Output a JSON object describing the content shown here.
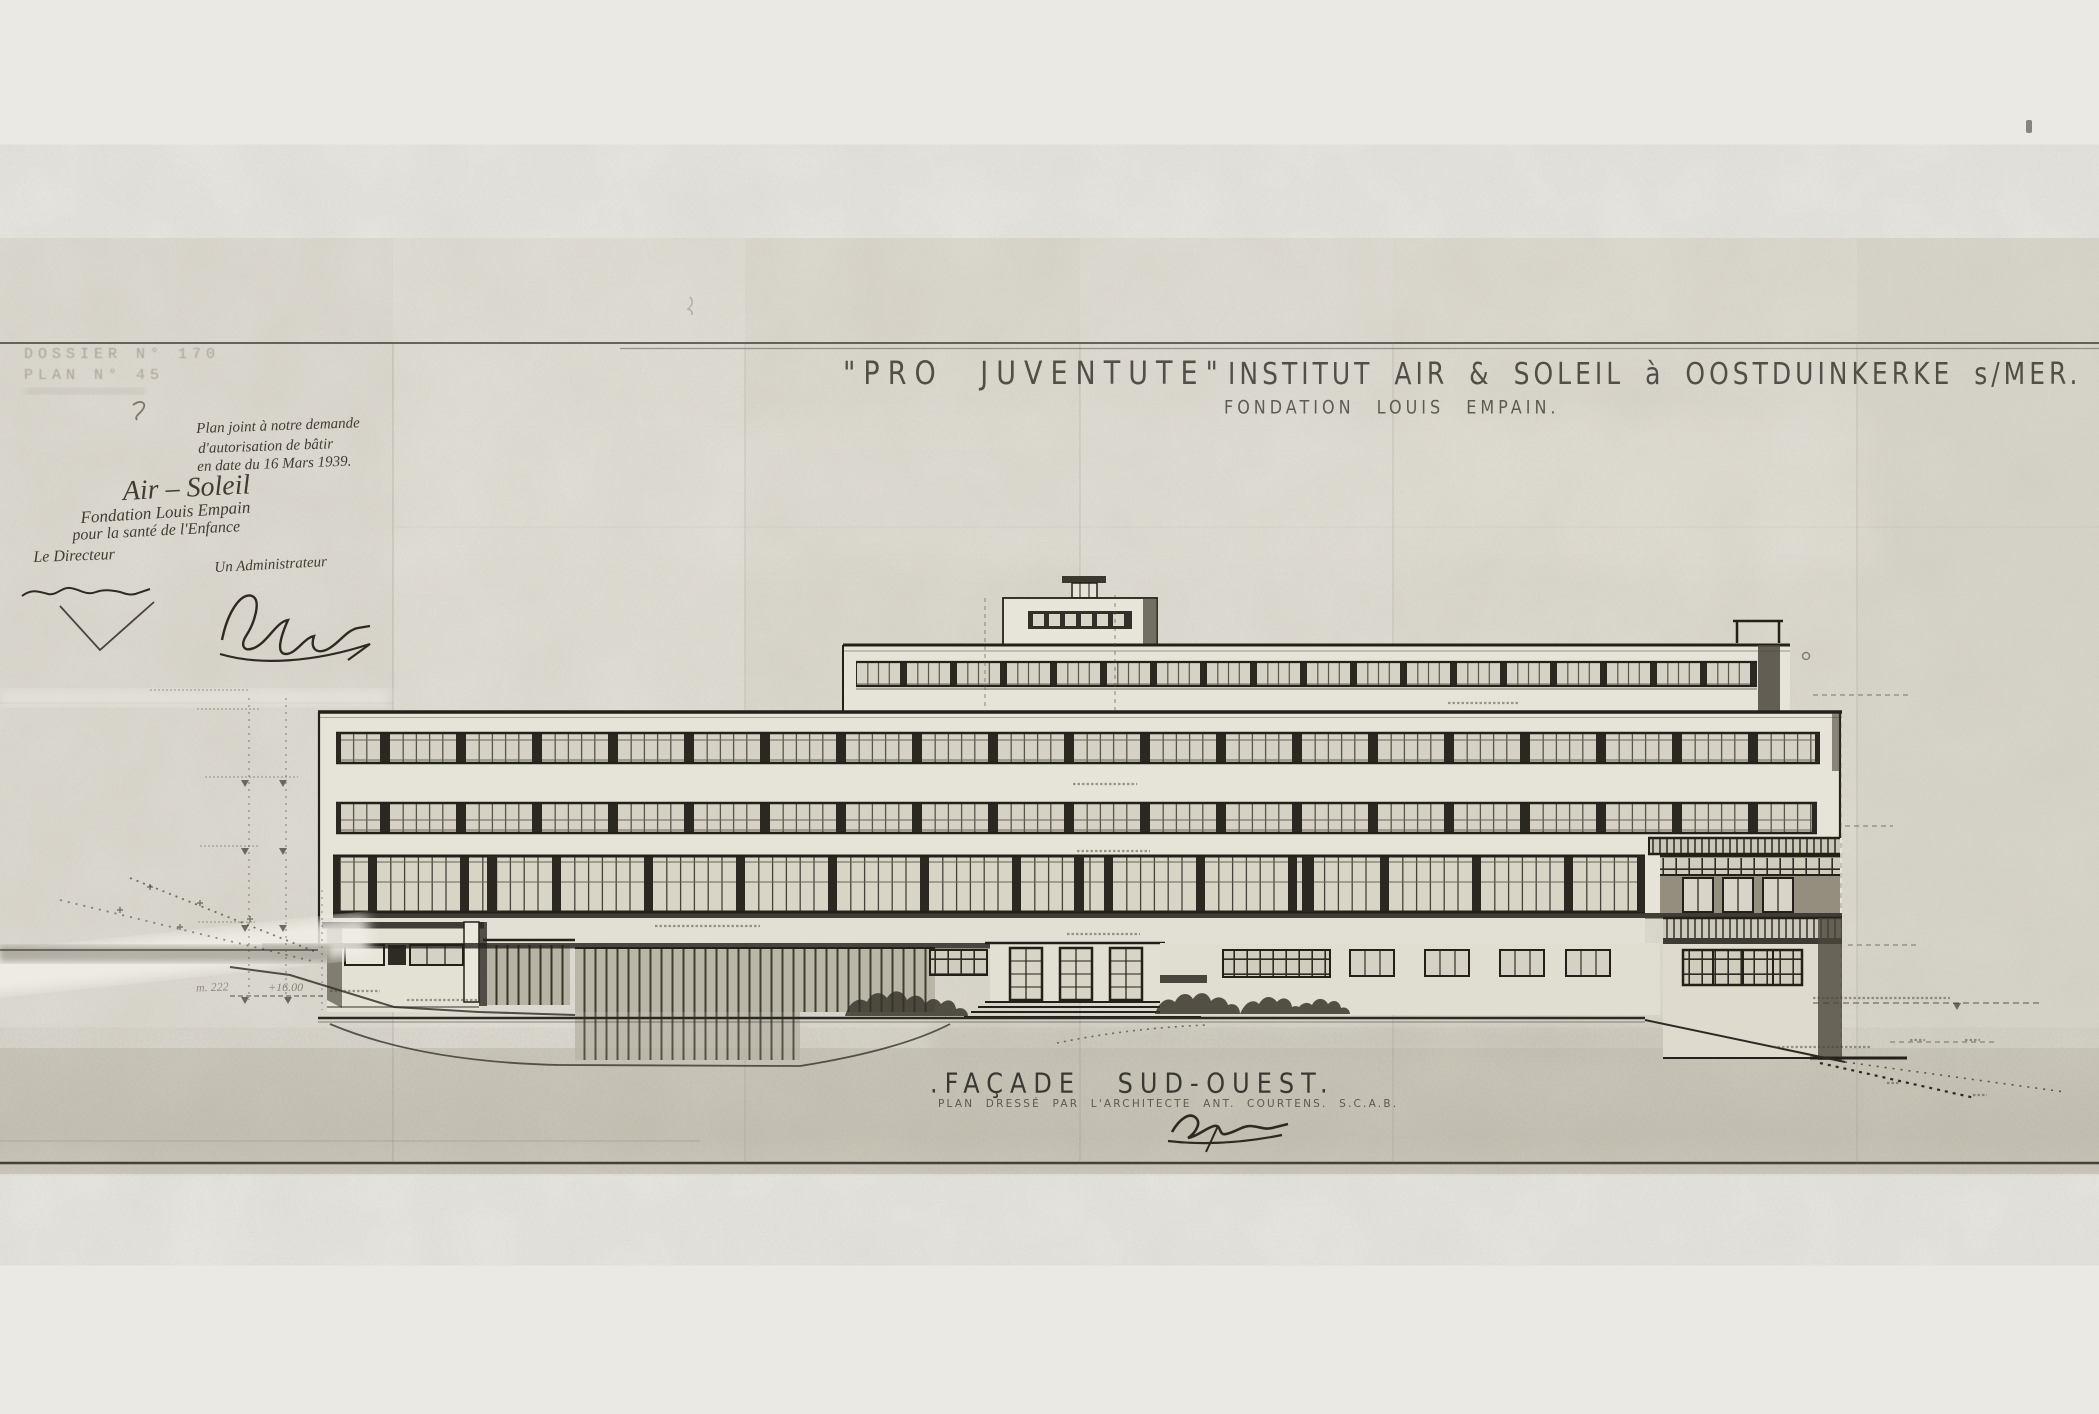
{
  "stamp": {
    "line1": "DOSSIER N° 170",
    "line2": "PLAN N° 45"
  },
  "handwriting": {
    "note1": "Plan joint à notre demande",
    "note2": "d'autorisation de bâtir",
    "note3": "en date du 16 Mars 1939.",
    "org_title": "Air – Soleil",
    "org_line1": "Fondation Louis Empain",
    "org_line2": "pour la santé de l'Enfance",
    "director_label": "Le Directeur",
    "administrator_label": "Un Administrateur"
  },
  "title_block": {
    "project": "\"PRO JUVENTUTE\"",
    "institute": "INSTITUT AIR & SOLEIL à OOSTDUINKERKE s/MER.",
    "subtitle": "FONDATION LOUIS EMPAIN."
  },
  "caption": {
    "title": ".FAÇADE SUD-OUEST.",
    "subtitle": "PLAN DRESSÉ PAR L'ARCHITECTE ANT. COURTENS. S.C.A.B."
  },
  "annotations": {
    "level_left": "m. 222",
    "level_plus": "+16.00"
  },
  "colors": {
    "paper": "#eae9e4",
    "sheet": "#e1ded5",
    "ink": "#23201a",
    "pane": "#d5d1c4",
    "shadow": "#6e6a5e"
  }
}
